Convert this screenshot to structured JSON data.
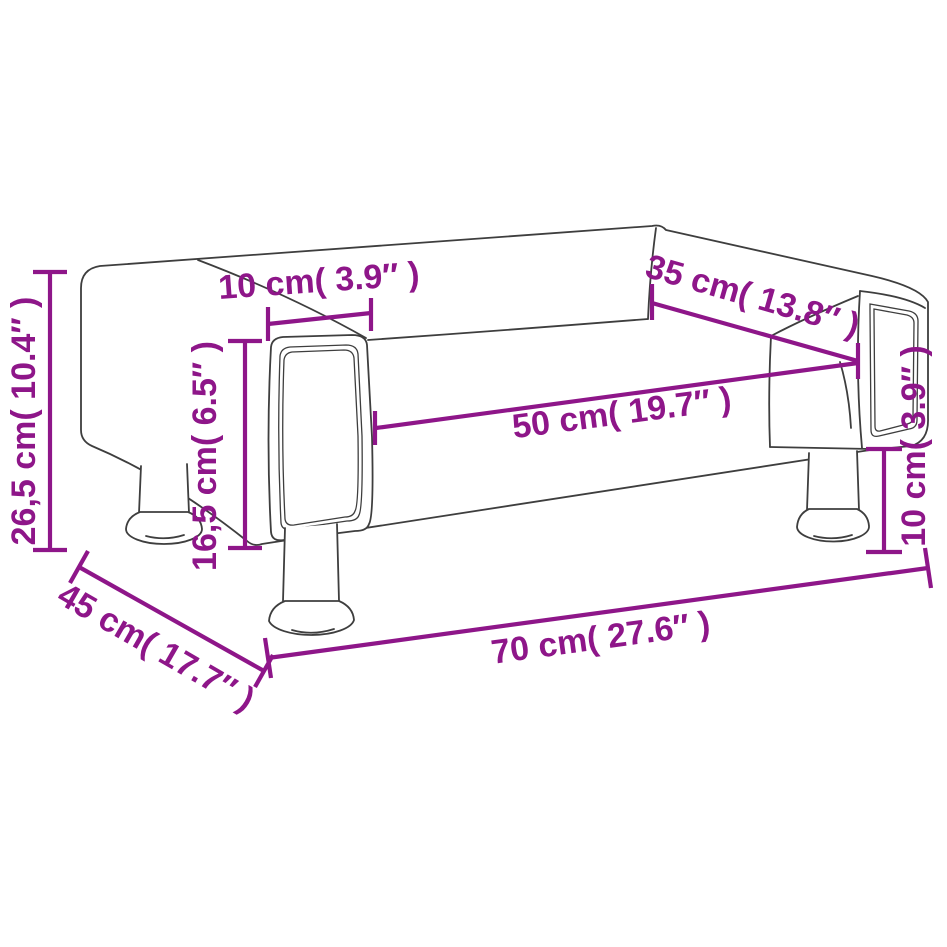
{
  "diagram": {
    "colors": {
      "dimension": "#8e1689",
      "outline": "#3e3e3e",
      "background": "#ffffff"
    },
    "dimensions": {
      "total_height": "26,5 cm( 10.4″ )",
      "armrest_width": "10 cm( 3.9″ )",
      "seat_height": "16,5 cm( 6.5″ )",
      "seat_depth": "35 cm( 13.8″ )",
      "seat_width": "50 cm( 19.7″ )",
      "leg_height": "10 cm( 3.9″ )",
      "total_width": "70 cm( 27.6″ )",
      "total_depth": "45 cm( 17.7″ )"
    }
  }
}
